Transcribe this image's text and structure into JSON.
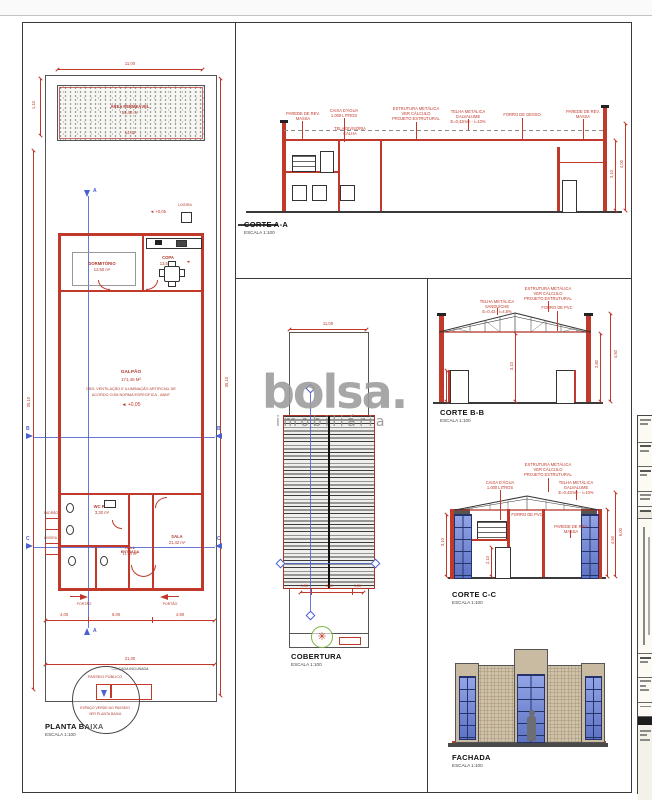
{
  "watermark": {
    "brand": "bolsa.",
    "tagline": "imobiliária"
  },
  "icons": {
    "tree": "✳",
    "level_arrow": "◄"
  },
  "planta": {
    "title": "PLANTA BAIXA",
    "scale": "ESCALA 1:100",
    "permeavel_l1": "ÁREA PERMEÁVEL",
    "permeavel_l2": "59,40 m²",
    "dim_11": "11,00",
    "dim_1440": "14,40",
    "dim_110": "1,10",
    "dim_3510": "35,10",
    "dim_400": "4,00",
    "dim_600": "6,00",
    "dim_480": "4,80",
    "dim_2100": "21,00",
    "lixeira": "LIXEIRA",
    "nivel": "+0,05",
    "dormitorio": "DORMITÓRIO",
    "dormitorio_area": "12,50 m²",
    "copa": "COPA",
    "copa_area": "13,53 m²",
    "galpao": "GALPÃO",
    "galpao_area": "171,45 M²",
    "galpao_obs1": "OBS: VENTILAÇÃO E ILUMINAÇÃO ARTIFICIAL DE",
    "galpao_obs2": "ACORDO COM NORMA ESPECÍFICA - ABNT",
    "wc": "WC PNE",
    "wc_area": "3,30 m²",
    "hall": "HALL ENTRADA",
    "hall_area": "11,55 m²",
    "sala": "SALA",
    "sala_area": "21,42 m²",
    "padrao": "PADRÃO",
    "portao": "PORTÃO",
    "calcada": "CALÇADA INCLINADA",
    "passeio": "PASSEIO PÚBLICO",
    "passeio_obs1": "ESPAÇO VERDE NO PASSEIO",
    "passeio_obs2": "VER PLANTA BAIXA",
    "sec_a": "A",
    "sec_b": "B",
    "sec_c": "C"
  },
  "corte_aa": {
    "title": "CORTE A-A",
    "scale": "ESCALA 1:100",
    "c1": "PAREDE DE REV.\nMASSA",
    "c2": "CAIXA D'ÁGUA\n1.000 LITROS",
    "c3": "TELA DIVISÓRIA\nCALHA",
    "c4": "ESTRUTURA METÁLICA\nVER CÁLCULO\nPROJETO ESTRUTURAL",
    "c5": "TELHA METÁLICA GALVALUME\nE=0,43mm - i=10%",
    "c6": "FORRO DE GESSO",
    "c7": "PAREDE DE REV.\nMASSA",
    "d1": "3,10",
    "d2": "4,00"
  },
  "corte_bb": {
    "title": "CORTE B-B",
    "scale": "ESCALA 1:100",
    "c1": "TELHA METÁLICA SANDUÍCHE\nE=0,43 - i=4,5%",
    "c2": "ESTRUTURA METÁLICA\nVER CÁLCULO\nPROJETO ESTRUTURAL",
    "c3": "FORRO DE PVC",
    "d1": "3,10",
    "d2": "2,80",
    "d3": "4,50",
    "d4": "2,10"
  },
  "corte_cc": {
    "title": "CORTE C-C",
    "scale": "ESCALA 1:100",
    "c1": "CAIXA D'ÁGUA\n1.000 LITROS",
    "c2": "ESTRUTURA METÁLICA\nVER CÁLCULO\nPROJETO ESTRUTURAL",
    "c3": "TELHA METÁLICA GALVALUME\nE=0,43mm - i=10%",
    "c4": "FORRO DE PVC",
    "c5": "PAREDE DE REV. MASSA",
    "d1": "3,10",
    "d2": "4,50",
    "d3": "6,00",
    "d4": "2,10"
  },
  "cobertura": {
    "title": "COBERTURA",
    "scale": "ESCALA 1:100",
    "dim_top": "11,00",
    "d1": "1,50",
    "d2": "8,00",
    "d3": "1,50"
  },
  "fachada": {
    "title": "FACHADA",
    "scale": "ESCALA 1:100"
  }
}
